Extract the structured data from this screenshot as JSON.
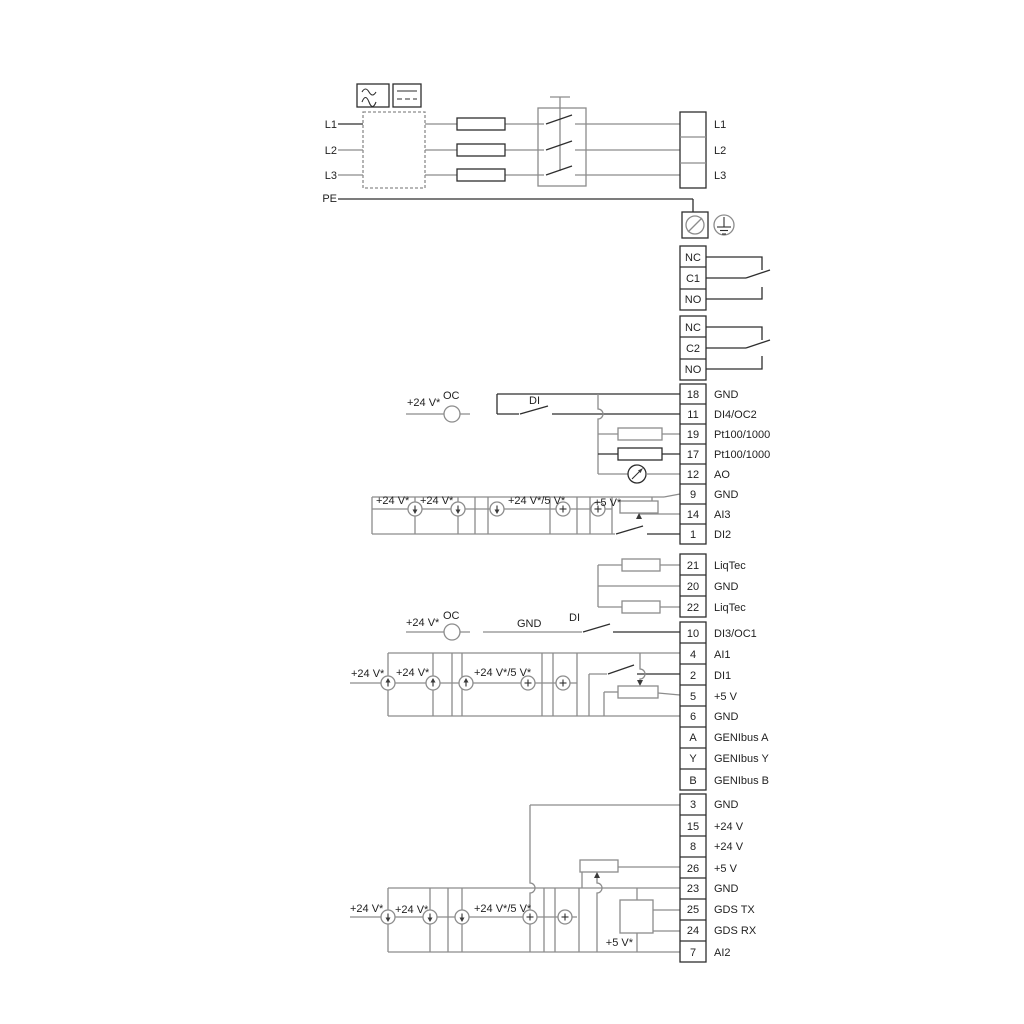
{
  "colors": {
    "background": "#ffffff",
    "wire_gray": "#8c8c8c",
    "wire_black": "#2e2e2e",
    "text": "#1f1f1f"
  },
  "mains": {
    "left_labels": [
      "L1",
      "L2",
      "L3",
      "PE"
    ],
    "motor_terminals": [
      "L1",
      "L2",
      "L3"
    ]
  },
  "relay1": [
    "NC",
    "C1",
    "NO"
  ],
  "relay2": [
    "NC",
    "C2",
    "NO"
  ],
  "io1": [
    {
      "num": "18",
      "label": "GND"
    },
    {
      "num": "11",
      "label": "DI4/OC2"
    },
    {
      "num": "19",
      "label": "Pt100/1000"
    },
    {
      "num": "17",
      "label": "Pt100/1000"
    },
    {
      "num": "12",
      "label": "AO"
    },
    {
      "num": "9",
      "label": "GND"
    },
    {
      "num": "14",
      "label": "AI3"
    },
    {
      "num": "1",
      "label": "DI2"
    }
  ],
  "liqtec": [
    {
      "num": "21",
      "label": "LiqTec"
    },
    {
      "num": "20",
      "label": "GND"
    },
    {
      "num": "22",
      "label": "LiqTec"
    }
  ],
  "io2": [
    {
      "num": "10",
      "label": "DI3/OC1"
    },
    {
      "num": "4",
      "label": "AI1"
    },
    {
      "num": "2",
      "label": "DI1"
    },
    {
      "num": "5",
      "label": "+5 V"
    },
    {
      "num": "6",
      "label": "GND"
    },
    {
      "num": "A",
      "label": "GENIbus A"
    },
    {
      "num": "Y",
      "label": "GENIbus Y"
    },
    {
      "num": "B",
      "label": "GENIbus B"
    }
  ],
  "io3": [
    {
      "num": "3",
      "label": "GND"
    },
    {
      "num": "15",
      "label": "+24 V"
    },
    {
      "num": "8",
      "label": "+24 V"
    },
    {
      "num": "26",
      "label": "+5 V"
    },
    {
      "num": "23",
      "label": "GND"
    },
    {
      "num": "25",
      "label": "GDS TX"
    },
    {
      "num": "24",
      "label": "GDS RX"
    },
    {
      "num": "7",
      "label": "AI2"
    }
  ],
  "ann": {
    "v24": "+24 V*",
    "v24_5": "+24 V*/5 V*",
    "v5": "+5 V*",
    "oc": "OC",
    "di": "DI",
    "gnd": "GND"
  }
}
